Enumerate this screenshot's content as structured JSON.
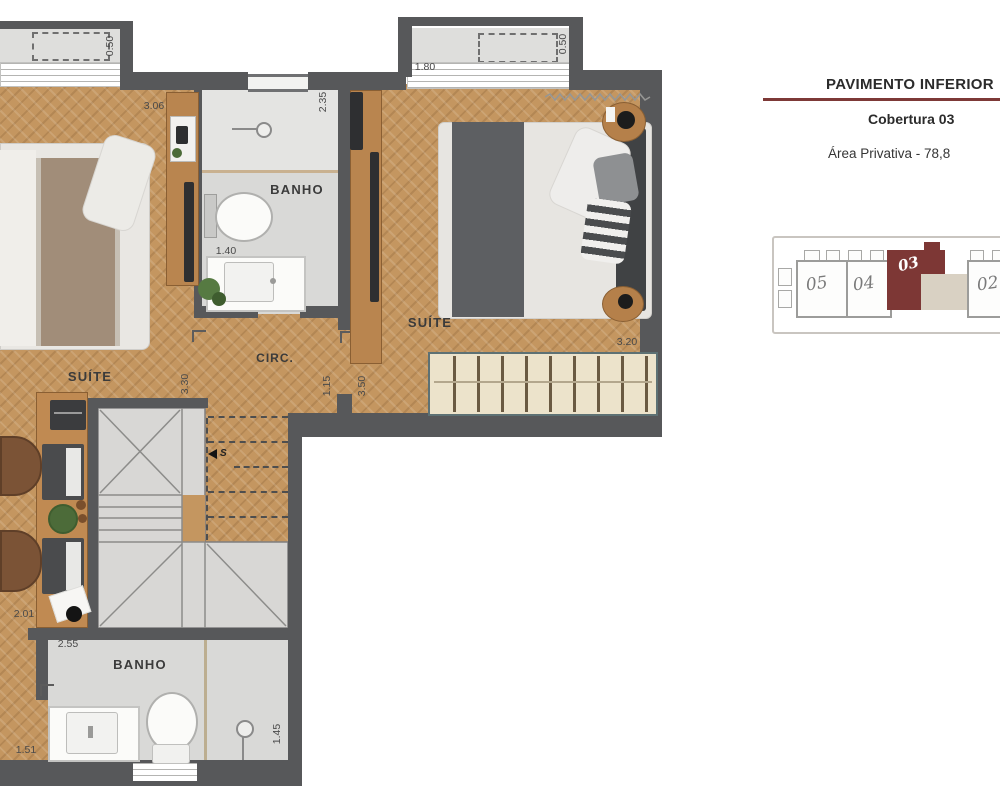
{
  "header": {
    "title": "PAVIMENTO INFERIOR",
    "subtitle": "Cobertura 03",
    "area_text": "Área Privativa - 78,8"
  },
  "key_plan": {
    "units": [
      {
        "label": "05"
      },
      {
        "label": "04"
      },
      {
        "label": "03"
      },
      {
        "label": "02"
      }
    ],
    "highlighted_unit": "03"
  },
  "rooms": {
    "suite1_label": "SUÍTE",
    "suite2_label": "SUÍTE",
    "banho1_label": "BANHO",
    "banho2_label": "BANHO",
    "circ_label": "CIRC."
  },
  "dimensions": {
    "balcony_depth": "0.50",
    "suite1_width": "3.06",
    "banho1_length": "2.35",
    "bay_width": "1.80",
    "bay_depth": "0.50",
    "banho1_width": "1.40",
    "circ_length": "3.30",
    "circ_width": "1.15",
    "suite2_length": "3.50",
    "suite2_width": "3.20",
    "office_width": "2.01",
    "banho2_width": "2.55",
    "hall_width": "1.51",
    "banho2_length": "1.45"
  },
  "stairs": {
    "direction_label": "S"
  },
  "colors": {
    "wall": "#57585a",
    "wood_floor": "#c49660",
    "tile_floor": "#d9d9d7",
    "accent": "#7d3937"
  }
}
